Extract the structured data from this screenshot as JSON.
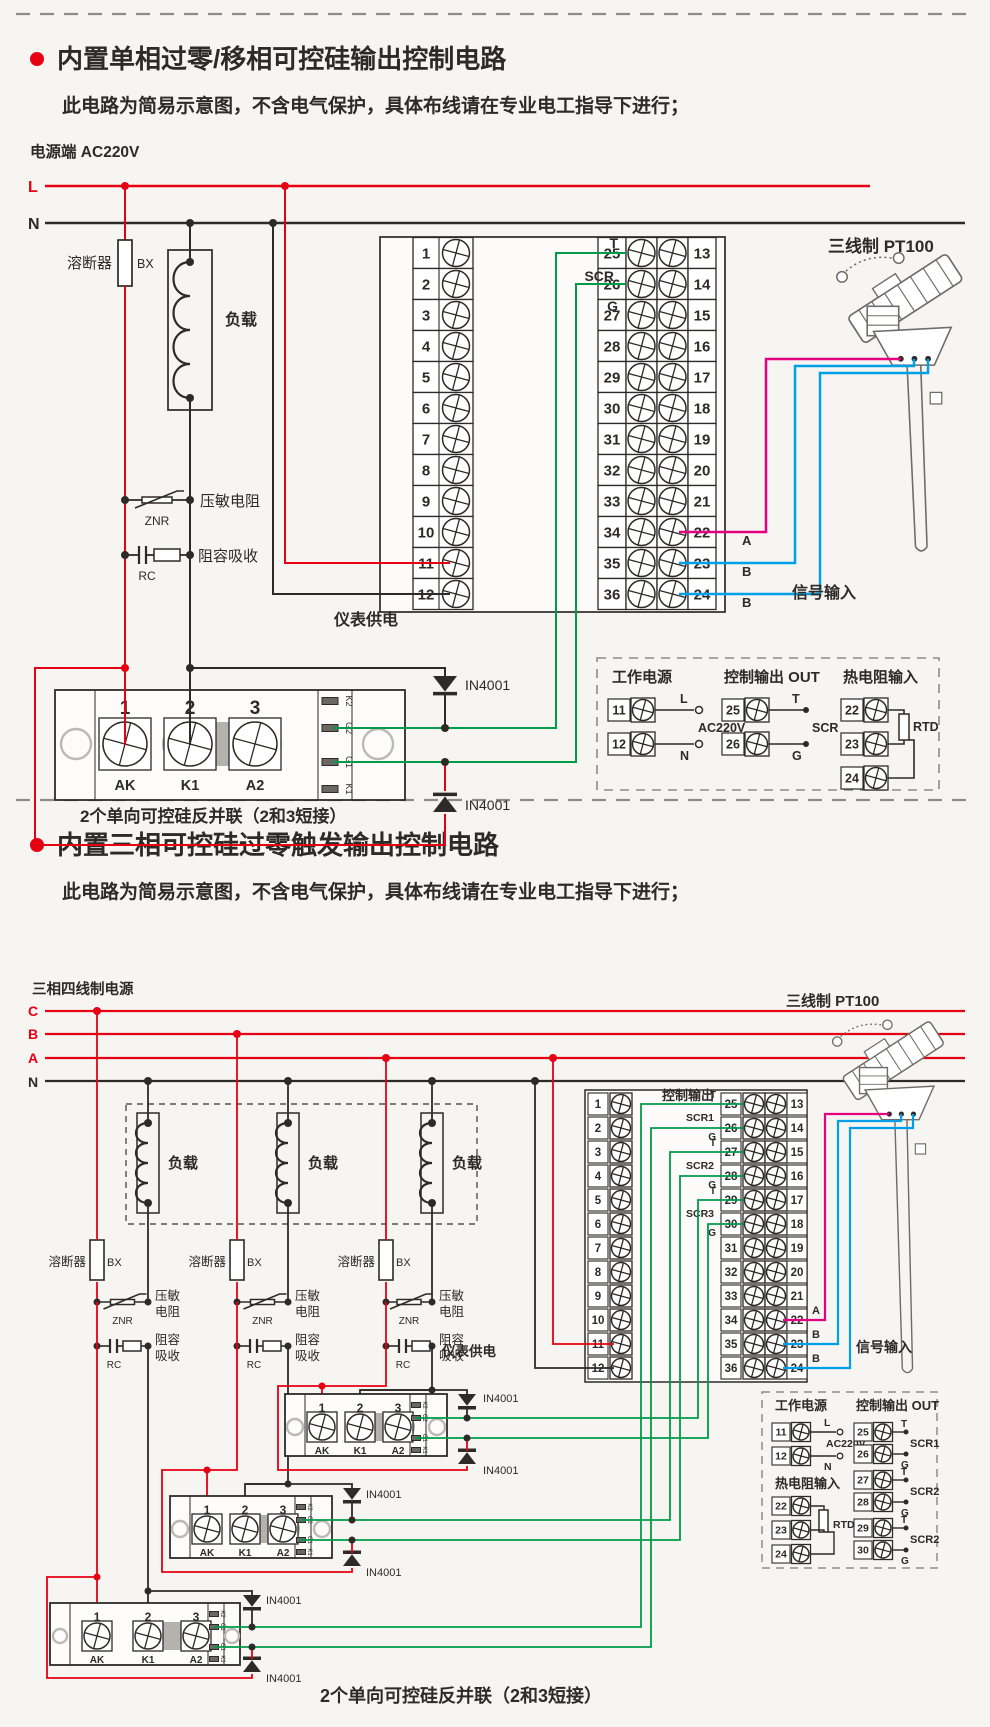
{
  "colors": {
    "red": "#e60012",
    "ink": "#2d2a27",
    "green": "#009b48",
    "magenta": "#e4007f",
    "cyan": "#00a0e9",
    "gray": "#8f8b87"
  },
  "terminals": {
    "left": [
      "1",
      "2",
      "3",
      "4",
      "5",
      "6",
      "7",
      "8",
      "9",
      "10",
      "11",
      "12"
    ],
    "mid": [
      "25",
      "26",
      "27",
      "28",
      "29",
      "30",
      "31",
      "32",
      "33",
      "34",
      "35",
      "36"
    ],
    "right": [
      "13",
      "14",
      "15",
      "16",
      "17",
      "18",
      "19",
      "20",
      "21",
      "22",
      "23",
      "24"
    ]
  },
  "section1": {
    "title": "内置单相过零/移相可控硅输出控制电路",
    "subtitle": "此电路为简易示意图，不含电气保护，具体布线请在专业电工指导下进行；",
    "power_label": "电源端  AC220V",
    "line_l": "L",
    "line_n": "N",
    "fuse_label": "溶断器",
    "fuse_code": "BX",
    "load_label": "负载",
    "znr_label": "压敏电阻",
    "znr_code": "ZNR",
    "rc_label": "阻容吸收",
    "rc_code": "RC",
    "meter_supply": "仪表供电",
    "out_t": "T",
    "out_scr": "SCR",
    "out_g": "G",
    "diode": "IN4001",
    "sensor_title": "三线制 PT100",
    "signal_input": "信号输入",
    "wire_a": "A",
    "wire_b1": "B",
    "wire_b2": "B",
    "module": {
      "n1": "1",
      "n2": "2",
      "n3": "3",
      "b1": "AK",
      "b2": "K1",
      "b3": "A2",
      "side": [
        "K2",
        "G2",
        "G1",
        "K1"
      ]
    },
    "caption": "2个单向可控硅反并联（2和3短接）",
    "legend": {
      "work_power": "工作电源",
      "ctrl_out": "控制输出 OUT",
      "rtd_in": "热电阻输入",
      "t11": "11",
      "t12": "12",
      "t25": "25",
      "t26": "26",
      "t22": "22",
      "t23": "23",
      "t24": "24",
      "l": "L",
      "n": "N",
      "ac": "AC220V",
      "t": "T",
      "scr": "SCR",
      "g": "G",
      "rtd": "RTD"
    }
  },
  "section2": {
    "title": "内置三相可控硅过零触发输出控制电路",
    "subtitle": "此电路为简易示意图，不含电气保护，具体布线请在专业电工指导下进行；",
    "power_label": "三相四线制电源",
    "phases": [
      "C",
      "B",
      "A",
      "N"
    ],
    "load_label": "负载",
    "fuse_label": "溶断器",
    "fuse_code": "BX",
    "znr_l1": "压敏",
    "znr_l2": "电阻",
    "znr_code": "ZNR",
    "rc_l1": "阻容",
    "rc_l2": "吸收",
    "rc_code": "RC",
    "meter_supply": "仪表供电",
    "ctrl_out_label": "控制输出",
    "rows": {
      "t": "T",
      "g": "G",
      "scr1": "SCR1",
      "scr2": "SCR2",
      "scr3": "SCR3"
    },
    "diode": "IN4001",
    "sensor_title": "三线制 PT100",
    "signal_input": "信号输入",
    "wire_a": "A",
    "wire_b1": "B",
    "wire_b2": "B",
    "module": {
      "n1": "1",
      "n2": "2",
      "n3": "3",
      "b1": "AK",
      "b2": "K1",
      "b3": "A2",
      "side": [
        "K2",
        "G2",
        "G1",
        "K1"
      ]
    },
    "caption": "2个单向可控硅反并联（2和3短接）",
    "legend": {
      "work_power": "工作电源",
      "ctrl_out": "控制输出 OUT",
      "rtd_in": "热电阻输入",
      "t11": "11",
      "t12": "12",
      "t22": "22",
      "t23": "23",
      "t24": "24",
      "t25": "25",
      "t26": "26",
      "t27": "27",
      "t28": "28",
      "t29": "29",
      "t30": "30",
      "l": "L",
      "n": "N",
      "ac": "AC220V",
      "t": "T",
      "g": "G",
      "rtd": "RTD",
      "scr1": "SCR1",
      "scr2": "SCR2",
      "scr3": "SCR2"
    }
  }
}
